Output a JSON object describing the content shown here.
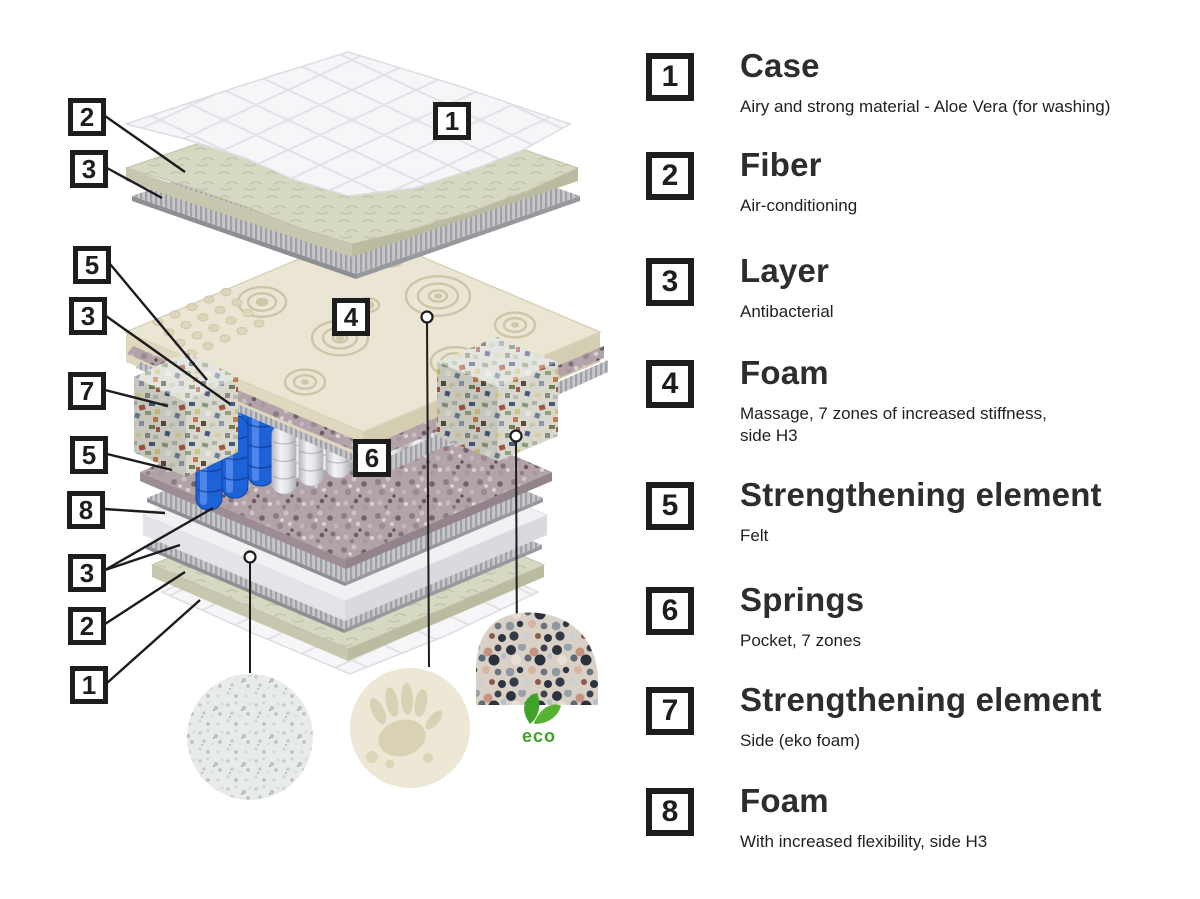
{
  "legend": {
    "items": [
      {
        "num": "1",
        "title": "Case",
        "desc": "Airy and strong material - Aloe Vera (for washing)"
      },
      {
        "num": "2",
        "title": "Fiber",
        "desc": "Air-conditioning"
      },
      {
        "num": "3",
        "title": "Layer",
        "desc": "Antibacterial"
      },
      {
        "num": "4",
        "title": "Foam",
        "desc": "Massage, 7 zones of increased stiffness,",
        "desc2": "side H3"
      },
      {
        "num": "5",
        "title": "Strengthening element",
        "desc": "Felt"
      },
      {
        "num": "6",
        "title": "Springs",
        "desc": "Pocket, 7 zones"
      },
      {
        "num": "7",
        "title": "Strengthening element",
        "desc": "Side (eko foam)"
      },
      {
        "num": "8",
        "title": "Foam",
        "desc": "With increased flexibility, side H3"
      }
    ]
  },
  "diagram": {
    "callouts": [
      {
        "num": "2"
      },
      {
        "num": "3"
      },
      {
        "num": "5"
      },
      {
        "num": "3"
      },
      {
        "num": "7"
      },
      {
        "num": "5"
      },
      {
        "num": "8"
      },
      {
        "num": "3"
      },
      {
        "num": "2"
      },
      {
        "num": "1"
      },
      {
        "num": "1"
      },
      {
        "num": "4"
      },
      {
        "num": "6"
      }
    ],
    "eco_badge": "eco"
  },
  "colors": {
    "outline": "#1d1d1d",
    "spring_blue": "#1e62d8",
    "eco_green": "#3fa32a",
    "foam_cream": "#ebe6d3",
    "fiber_green": "#d7d8c2"
  }
}
